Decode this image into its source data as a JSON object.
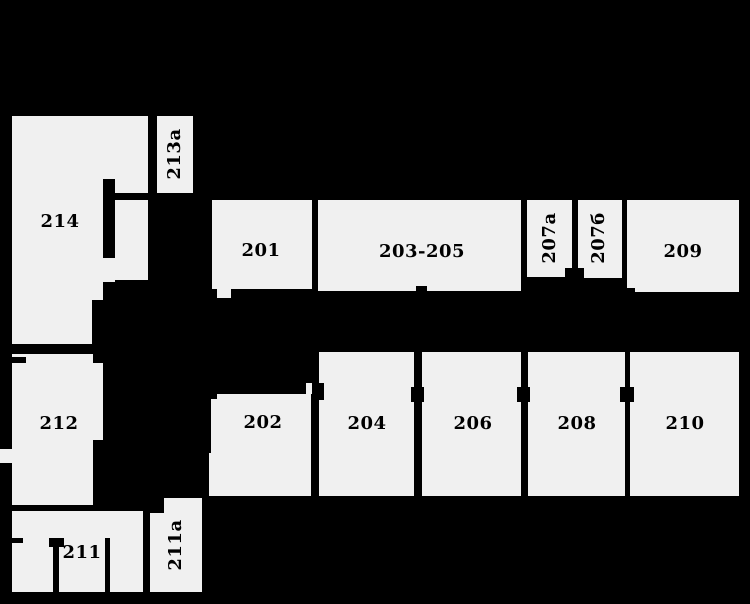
{
  "plan": {
    "title": "floor-plan-second-floor",
    "background_color": "#000000",
    "room_fill_color": "#f0f0f0",
    "label_color": "#000000",
    "rooms": [
      {
        "id": "214",
        "label": "214",
        "rotated": false,
        "label_pos": {
          "x": 60,
          "y": 222
        },
        "rects": [
          {
            "x": 12,
            "y": 116,
            "w": 136,
            "h": 228
          }
        ]
      },
      {
        "id": "213a",
        "label": "213а",
        "rotated": true,
        "label_pos": {
          "x": 175,
          "y": 154
        },
        "rects": [
          {
            "x": 157,
            "y": 116,
            "w": 36,
            "h": 77
          }
        ]
      },
      {
        "id": "201",
        "label": "201",
        "rotated": false,
        "label_pos": {
          "x": 261,
          "y": 251
        },
        "rects": [
          {
            "x": 212,
            "y": 200,
            "w": 100,
            "h": 89
          },
          {
            "x": 217,
            "y": 289,
            "w": 14,
            "h": 9
          }
        ]
      },
      {
        "id": "203-205",
        "label": "203-205",
        "rotated": false,
        "label_pos": {
          "x": 422,
          "y": 252
        },
        "rects": [
          {
            "x": 318,
            "y": 200,
            "w": 203,
            "h": 91
          }
        ]
      },
      {
        "id": "207a",
        "label": "207а",
        "rotated": true,
        "label_pos": {
          "x": 550,
          "y": 238
        },
        "rects": [
          {
            "x": 527,
            "y": 200,
            "w": 45,
            "h": 77
          }
        ]
      },
      {
        "id": "207b",
        "label": "207б",
        "rotated": true,
        "label_pos": {
          "x": 599,
          "y": 238
        },
        "rects": [
          {
            "x": 578,
            "y": 200,
            "w": 44,
            "h": 78
          }
        ]
      },
      {
        "id": "209",
        "label": "209",
        "rotated": false,
        "label_pos": {
          "x": 683,
          "y": 252
        },
        "rects": [
          {
            "x": 627,
            "y": 200,
            "w": 112,
            "h": 92
          }
        ]
      },
      {
        "id": "212",
        "label": "212",
        "rotated": false,
        "label_pos": {
          "x": 59,
          "y": 424
        },
        "rects": [
          {
            "x": 12,
            "y": 354,
            "w": 81,
            "h": 151
          },
          {
            "x": 93,
            "y": 363,
            "w": 10,
            "h": 77
          },
          {
            "x": 0,
            "y": 449,
            "w": 12,
            "h": 14
          }
        ]
      },
      {
        "id": "202",
        "label": "202",
        "rotated": false,
        "label_pos": {
          "x": 263,
          "y": 423
        },
        "rects": [
          {
            "x": 211,
            "y": 394,
            "w": 100,
            "h": 102
          },
          {
            "x": 209,
            "y": 453,
            "w": 2,
            "h": 43
          },
          {
            "x": 306,
            "y": 383,
            "w": 6,
            "h": 11
          }
        ]
      },
      {
        "id": "204",
        "label": "204",
        "rotated": false,
        "label_pos": {
          "x": 367,
          "y": 424
        },
        "rects": [
          {
            "x": 319,
            "y": 352,
            "w": 95,
            "h": 144
          }
        ]
      },
      {
        "id": "206",
        "label": "206",
        "rotated": false,
        "label_pos": {
          "x": 473,
          "y": 424
        },
        "rects": [
          {
            "x": 422,
            "y": 352,
            "w": 99,
            "h": 144
          }
        ]
      },
      {
        "id": "208",
        "label": "208",
        "rotated": false,
        "label_pos": {
          "x": 577,
          "y": 424
        },
        "rects": [
          {
            "x": 528,
            "y": 352,
            "w": 97,
            "h": 144
          }
        ]
      },
      {
        "id": "210",
        "label": "210",
        "rotated": false,
        "label_pos": {
          "x": 685,
          "y": 424
        },
        "rects": [
          {
            "x": 630,
            "y": 352,
            "w": 109,
            "h": 144
          }
        ]
      },
      {
        "id": "211",
        "label": "211",
        "rotated": false,
        "label_pos": {
          "x": 82,
          "y": 553
        },
        "rects": [
          {
            "x": 12,
            "y": 511,
            "w": 131,
            "h": 81
          }
        ]
      },
      {
        "id": "211a",
        "label": "211а",
        "rotated": true,
        "label_pos": {
          "x": 176,
          "y": 545
        },
        "rects": [
          {
            "x": 150,
            "y": 513,
            "w": 52,
            "h": 79
          },
          {
            "x": 164,
            "y": 498,
            "w": 38,
            "h": 16
          }
        ]
      }
    ],
    "walls": [
      {
        "id": "room214-inner-wall-upper",
        "x": 103,
        "y": 179,
        "w": 12,
        "h": 79
      },
      {
        "id": "room214-inner-wall-top",
        "x": 115,
        "y": 193,
        "w": 33,
        "h": 7
      },
      {
        "id": "room214-inner-wall-lower",
        "x": 103,
        "y": 282,
        "w": 12,
        "h": 62
      },
      {
        "id": "room214-corner-block-right",
        "x": 115,
        "y": 280,
        "w": 33,
        "h": 64
      },
      {
        "id": "room214-corner-block-mid",
        "x": 92,
        "y": 300,
        "w": 11,
        "h": 44
      },
      {
        "id": "room203-205-door-jamb",
        "x": 416,
        "y": 286,
        "w": 11,
        "h": 6
      },
      {
        "id": "room207-bottom-step",
        "x": 565,
        "y": 268,
        "w": 19,
        "h": 11
      },
      {
        "id": "room209-corner-notch",
        "x": 627,
        "y": 288,
        "w": 8,
        "h": 5
      },
      {
        "id": "room202-corner-notch",
        "x": 211,
        "y": 394,
        "w": 6,
        "h": 5
      },
      {
        "id": "room212-wall-notch",
        "x": 12,
        "y": 357,
        "w": 14,
        "h": 6
      },
      {
        "id": "room211-wall-notch",
        "x": 12,
        "y": 538,
        "w": 11,
        "h": 5
      },
      {
        "id": "room211-jamb-cap",
        "x": 49,
        "y": 538,
        "w": 15,
        "h": 9
      },
      {
        "id": "room211-inner-wall-left",
        "x": 53,
        "y": 547,
        "w": 6,
        "h": 45
      },
      {
        "id": "room211-inner-wall-right",
        "x": 105,
        "y": 538,
        "w": 5,
        "h": 54
      }
    ],
    "door_markers": [
      {
        "id": "door-202-204",
        "x": 312,
        "y": 383,
        "w": 12,
        "h": 17
      },
      {
        "id": "door-204-206",
        "x": 411,
        "y": 387,
        "w": 13,
        "h": 15
      },
      {
        "id": "door-206-208",
        "x": 517,
        "y": 387,
        "w": 13,
        "h": 15
      },
      {
        "id": "door-208-210",
        "x": 620,
        "y": 387,
        "w": 14,
        "h": 15
      }
    ]
  }
}
